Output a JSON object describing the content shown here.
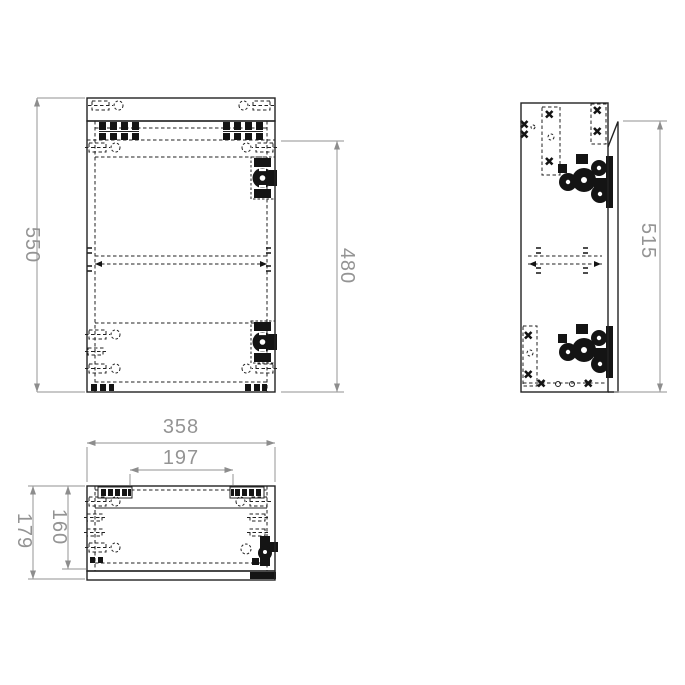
{
  "drawing": {
    "type": "furniture-cabinet-technical-drawing",
    "colors": {
      "background": "#ffffff",
      "line": "#222222",
      "dimension": "#949494"
    },
    "views": [
      {
        "id": "front-view",
        "position": "top-left"
      },
      {
        "id": "side-view",
        "position": "top-right"
      },
      {
        "id": "top-view",
        "position": "bottom-left"
      }
    ],
    "icons": [
      "hinge-icon",
      "drill-holes-icon",
      "mounting-plate-icon",
      "screw-cross-icon",
      "shelf-pin-icon",
      "arrowhead-icon"
    ],
    "dimensions": {
      "front_height": "550",
      "door_height": "480",
      "side_height": "515",
      "width": "358",
      "hinge_spacing": "197",
      "depth": "179",
      "inner_depth": "160"
    }
  }
}
